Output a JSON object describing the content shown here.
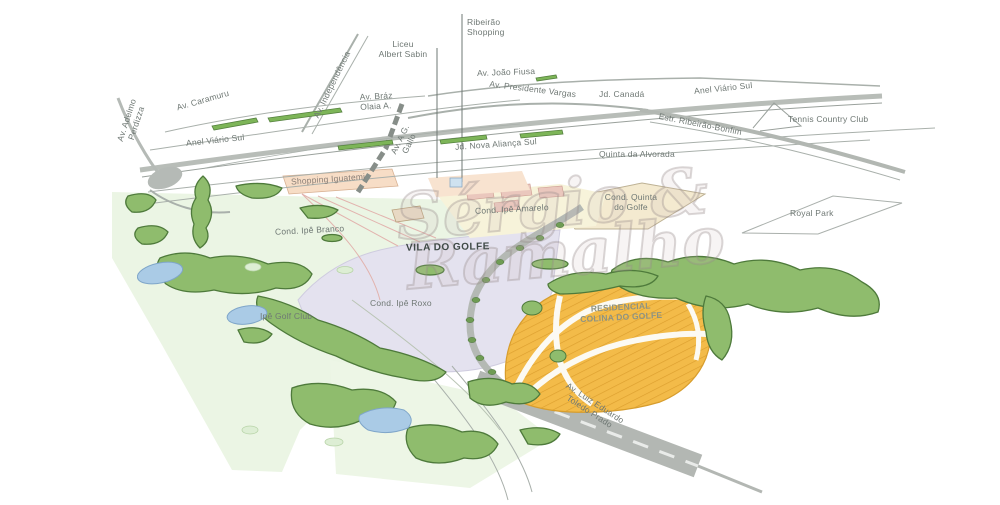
{
  "watermark": {
    "line1": "Sérgio &",
    "line2": "Ramalho"
  },
  "roads": {
    "av_adelmo_line1": "Av. Adelmo",
    "av_adelmo_line2": "Perdizza",
    "av_caramuru": "Av. Caramuru",
    "anel_viario_sul_left": "Anel Viário Sul",
    "anel_viario_sul_right": "Anel Viário Sul",
    "av_independencia": "Av. Independência",
    "av_joao_fiusa": "Av. João Fiusa",
    "av_braz_line1": "Av. Bráz",
    "av_braz_line2": "Olaia A.",
    "av_presidente_vargas": "Av. Presidente Vargas",
    "estr_ribeirao_bonfim": "Estr. Ribeirão-Bonfim",
    "av_ag_gallo_line1": "Av. A G.",
    "av_ag_gallo_line2": "Gallo",
    "av_luiz_line1": "Av. Luiz Eduardo",
    "av_luiz_line2": "Toledo Prado"
  },
  "places": {
    "ribeirao_shopping_line1": "Ribeirão",
    "ribeirao_shopping_line2": "Shopping",
    "liceu_line1": "Liceu",
    "liceu_line2": "Albert Sabin",
    "jd_canada": "Jd. Canadá",
    "tennis_country_club": "Tennis Country Club",
    "jd_nova_alianca_sul": "Jd. Nova Aliança Sul",
    "quinta_da_alvorada": "Quinta da Alvorada",
    "shopping_iguatemi": "Shopping Iguatemi",
    "royal_park": "Royal Park",
    "cond_quinta_line1": "Cond. Quinta",
    "cond_quinta_line2": "do Golfe",
    "cond_ipe_amarelo": "Cond. Ipê Amarelo",
    "cond_ipe_branco": "Cond. Ipê Branco",
    "vila_do_golfe": "VILA DO GOLFE",
    "cond_ipe_roxo": "Cond. Ipê Roxo",
    "ipe_golf_club": "Ipê Golf Club",
    "residencial_line1": "RESIDENCIAL",
    "residencial_line2": "COLINA DO GOLFE"
  },
  "palette": {
    "lots_orange": "#f2b843",
    "lots_stripe": "#dc9f2e",
    "golf_green_light": "#ebf5e4",
    "tree_green": "#8fbc6d",
    "tree_edge": "#4e7a3b",
    "pond_blue": "#aacbe6",
    "vila_lavender": "#e4e2ef",
    "quinta_cream": "#f4ead0",
    "amarelo_yellow": "#f7f3da",
    "iguatemi_peach": "#f7ddc6",
    "pink_blocks": "#eac7bd",
    "road_gray": "#b5bab6",
    "label_gray": "#6f7874"
  }
}
